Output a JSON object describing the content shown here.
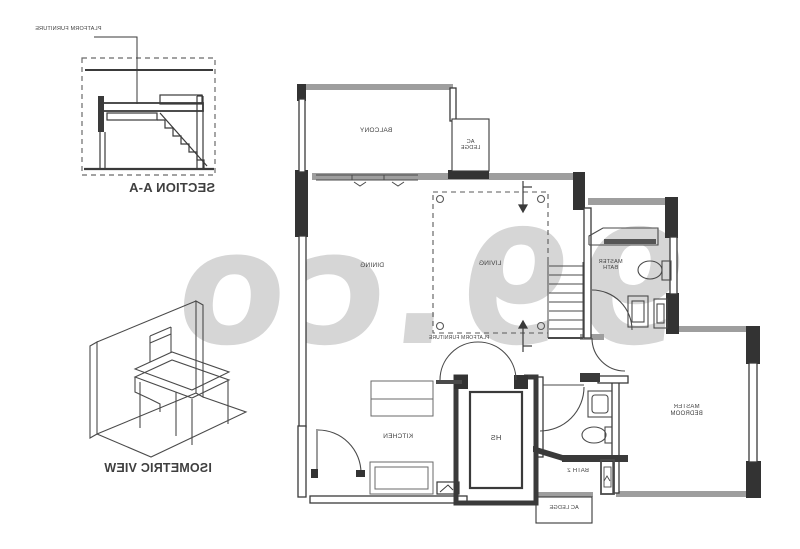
{
  "watermark": {
    "text": "99.co",
    "color": "#d6d6d6"
  },
  "section_view": {
    "caption": "SECTION A-A",
    "annotation": "PLATFORM FURNITURE"
  },
  "isometric_view": {
    "caption": "ISOMETRIC VIEW"
  },
  "floor_plan": {
    "rooms": {
      "balcony": "BALCONY",
      "ac_ledge_top": "AC LEDGE",
      "dining": "DINING",
      "living": "LIVING",
      "living_platform": "PLATFORM FURNITURE",
      "master_bath": "MASTER BATH",
      "master_bedroom": "MASTER BEDROOM",
      "kitchen": "KITCHEN",
      "household_shelter": "HS",
      "bath_2": "BATH 2",
      "ac_ledge_bottom": "AC LEDGE"
    },
    "colors": {
      "line_dark": "#3a3a3a",
      "wall_gray": "#9e9e9e",
      "watermark_gray": "#d6d6d6"
    },
    "note_mirrored": "all lettering appears horizontally mirrored"
  }
}
